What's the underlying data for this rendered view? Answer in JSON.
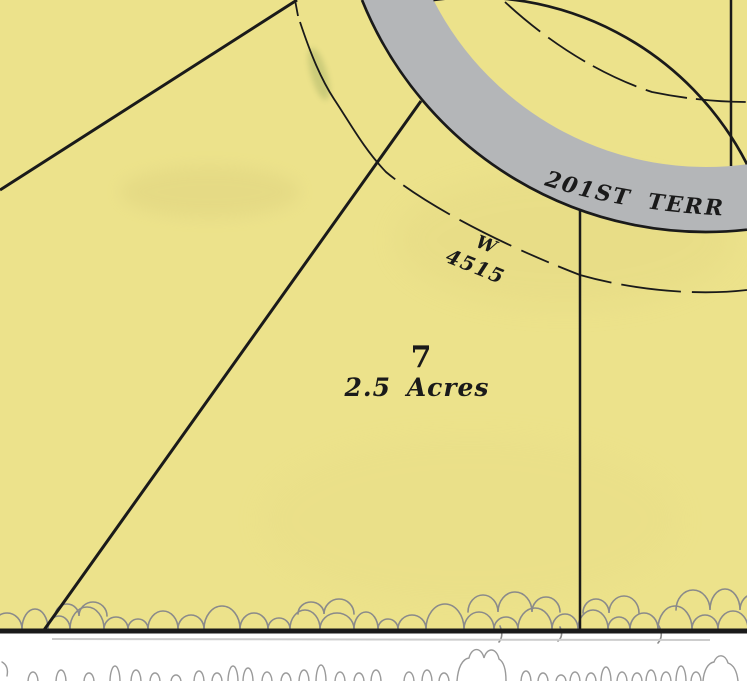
{
  "map": {
    "labels": {
      "street": "201ST TERRACE",
      "curve_bearing": "W",
      "curve_distance": "4515",
      "lot_number": "7",
      "lot_area": "2.5 Acres"
    }
  },
  "colors": {
    "parcel_fill": "#ece28b",
    "road_fill": "#b4b6b8",
    "line_black": "#1a1a1a",
    "tree_line_gray": "#8a8a8a",
    "marsh_gray": "#9a9a9a",
    "background_white": "#ffffff"
  }
}
